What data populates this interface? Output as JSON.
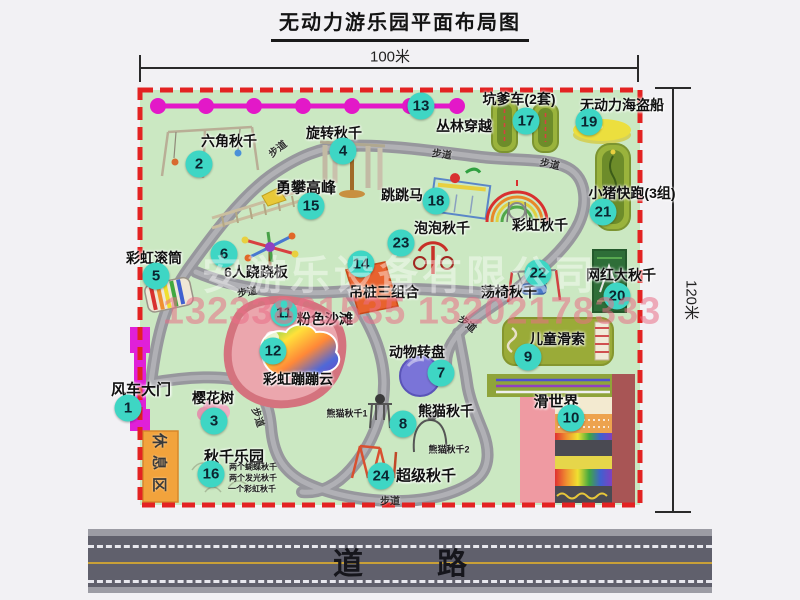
{
  "title": "无动力游乐园平面布局图",
  "dimensions": {
    "top": "100米",
    "right": "120米"
  },
  "road": {
    "label": "道　路"
  },
  "rest_area_label": "休息区",
  "watermark": {
    "company": "安游乐设备有限公司",
    "phone": "13233861535 13202178333"
  },
  "colors": {
    "park_green": "#cbe8c2",
    "border_red": "#e32222",
    "badge_teal": "#3ed6c4",
    "path_gray": "#97979d",
    "chain_magenta": "#e318c8",
    "gate_magenta": "#e020d8",
    "rest_orange": "#f2a33c",
    "road_gray": "#60606c",
    "road_line_yellow": "#c8a038"
  },
  "attractions": [
    {
      "num": "1",
      "name": "风车大门",
      "badge": {
        "x": 128,
        "y": 408
      },
      "label": {
        "x": 141,
        "y": 389,
        "size": 15
      }
    },
    {
      "num": "2",
      "name": "六角秋千",
      "badge": {
        "x": 199,
        "y": 164
      },
      "label": {
        "x": 229,
        "y": 141,
        "size": 14
      }
    },
    {
      "num": "3",
      "name": "樱花树",
      "badge": {
        "x": 214,
        "y": 421
      },
      "label": {
        "x": 213,
        "y": 398,
        "size": 14
      }
    },
    {
      "num": "4",
      "name": "旋转秋千",
      "badge": {
        "x": 343,
        "y": 151
      },
      "label": {
        "x": 334,
        "y": 133,
        "size": 14
      }
    },
    {
      "num": "5",
      "name": "彩虹滚筒",
      "badge": {
        "x": 156,
        "y": 276
      },
      "label": {
        "x": 154,
        "y": 258,
        "size": 14
      }
    },
    {
      "num": "6",
      "name": "6人跷跷板",
      "badge": {
        "x": 224,
        "y": 254
      },
      "label": {
        "x": 256,
        "y": 272,
        "size": 14
      }
    },
    {
      "num": "7",
      "name": "动物转盘",
      "badge": {
        "x": 441,
        "y": 373
      },
      "label": {
        "x": 417,
        "y": 352,
        "size": 14
      }
    },
    {
      "num": "8",
      "name": "熊猫秋千",
      "badge": {
        "x": 403,
        "y": 424
      },
      "label": {
        "x": 446,
        "y": 411,
        "size": 14
      }
    },
    {
      "num": "9",
      "name": "儿童滑索",
      "badge": {
        "x": 528,
        "y": 357
      },
      "label": {
        "x": 557,
        "y": 339,
        "size": 14
      }
    },
    {
      "num": "10",
      "name": "滑世界",
      "badge": {
        "x": 571,
        "y": 418
      },
      "label": {
        "x": 556,
        "y": 401,
        "size": 15
      }
    },
    {
      "num": "11",
      "name": "粉色沙滩",
      "badge": {
        "x": 284,
        "y": 313
      },
      "label": {
        "x": 325,
        "y": 319,
        "size": 14
      }
    },
    {
      "num": "12",
      "name": "彩虹蹦蹦云",
      "badge": {
        "x": 273,
        "y": 351
      },
      "label": {
        "x": 298,
        "y": 379,
        "size": 14
      }
    },
    {
      "num": "13",
      "name": "丛林穿越",
      "badge": {
        "x": 421,
        "y": 106
      },
      "label": {
        "x": 464,
        "y": 126,
        "size": 14
      }
    },
    {
      "num": "14",
      "name": "吊桩三组合",
      "badge": {
        "x": 361,
        "y": 264
      },
      "label": {
        "x": 384,
        "y": 292,
        "size": 14
      }
    },
    {
      "num": "15",
      "name": "勇攀高峰",
      "badge": {
        "x": 311,
        "y": 206
      },
      "label": {
        "x": 306,
        "y": 187,
        "size": 15
      }
    },
    {
      "num": "16",
      "name": "秋千乐园",
      "badge": {
        "x": 211,
        "y": 474
      },
      "label": {
        "x": 234,
        "y": 456,
        "size": 15
      }
    },
    {
      "num": "17",
      "name": "坑爹车(2套)",
      "badge": {
        "x": 526,
        "y": 121
      },
      "label": {
        "x": 519,
        "y": 99,
        "size": 14
      }
    },
    {
      "num": "18",
      "name": "跳跳马",
      "badge": {
        "x": 436,
        "y": 201
      },
      "label": {
        "x": 402,
        "y": 195,
        "size": 14
      }
    },
    {
      "num": "19",
      "name": "无动力海盗船",
      "badge": {
        "x": 589,
        "y": 122
      },
      "label": {
        "x": 622,
        "y": 105,
        "size": 14
      }
    },
    {
      "num": "20",
      "name": "网红大秋千",
      "badge": {
        "x": 617,
        "y": 296
      },
      "label": {
        "x": 621,
        "y": 275,
        "size": 14
      }
    },
    {
      "num": "21",
      "name": "小猪快跑(3组)",
      "badge": {
        "x": 603,
        "y": 212
      },
      "label": {
        "x": 632,
        "y": 193,
        "size": 14
      }
    },
    {
      "num": "22",
      "name": "荡椅秋千",
      "badge": {
        "x": 538,
        "y": 273
      },
      "label": {
        "x": 509,
        "y": 292,
        "size": 14
      }
    },
    {
      "num": "23",
      "name": "泡泡秋千",
      "badge": {
        "x": 401,
        "y": 243
      },
      "label": {
        "x": 442,
        "y": 228,
        "size": 14
      }
    },
    {
      "num": "24",
      "name": "超级秋千",
      "badge": {
        "x": 381,
        "y": 476
      },
      "label": {
        "x": 426,
        "y": 475,
        "size": 15
      }
    }
  ],
  "extra_labels": [
    {
      "text": "彩虹秋千",
      "x": 540,
      "y": 225,
      "size": 14
    }
  ],
  "sub_labels": [
    {
      "text": "熊猫秋千1",
      "x": 347,
      "y": 413,
      "size": 9
    },
    {
      "text": "熊猫秋千2",
      "x": 449,
      "y": 449,
      "size": 9
    },
    {
      "text": "两个蝴蝶秋千",
      "x": 253,
      "y": 467,
      "size": 8
    },
    {
      "text": "两个发光秋千",
      "x": 253,
      "y": 478,
      "size": 8
    },
    {
      "text": "一个彩虹秋千",
      "x": 252,
      "y": 489,
      "size": 8
    }
  ],
  "path_labels": [
    {
      "text": "步道",
      "x": 277,
      "y": 148,
      "rot": -38
    },
    {
      "text": "步道",
      "x": 442,
      "y": 153,
      "rot": 8
    },
    {
      "text": "步道",
      "x": 550,
      "y": 163,
      "rot": 12
    },
    {
      "text": "步道",
      "x": 247,
      "y": 291,
      "rot": -10
    },
    {
      "text": "步道",
      "x": 468,
      "y": 323,
      "rot": 40
    },
    {
      "text": "步道",
      "x": 259,
      "y": 417,
      "rot": 72
    },
    {
      "text": "步道",
      "x": 390,
      "y": 500,
      "rot": 0
    }
  ]
}
